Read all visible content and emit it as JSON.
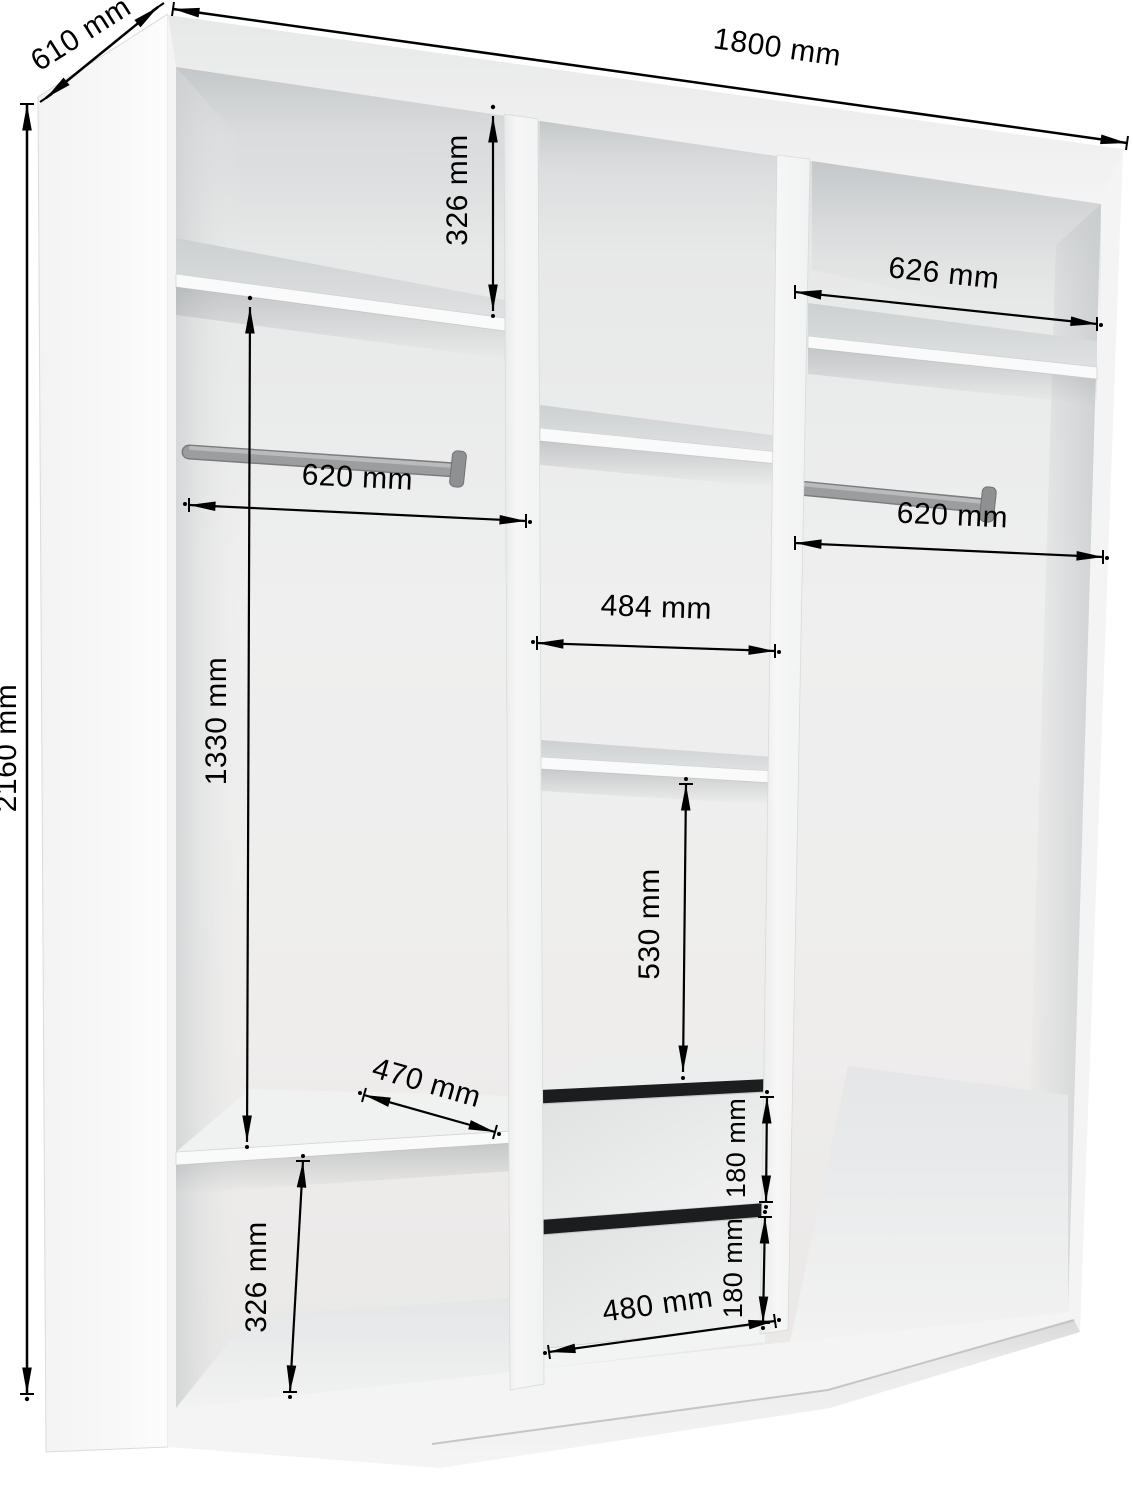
{
  "diagram": {
    "unit": "mm",
    "colors": {
      "dimension_lines": "#000000",
      "hanging_rail": "#9a9c9d",
      "drawer_gap": "#1b1d1f",
      "carcass": "#f4f4f4"
    },
    "dims": {
      "width": "1800 mm",
      "depth": "610 mm",
      "height": "2160 mm",
      "top_section_height": "326 mm",
      "right_shelf_width": "626 mm",
      "left_rail_width": "620 mm",
      "right_rail_width": "620 mm",
      "middle_shelf_width": "484 mm",
      "left_hanging_height": "1330 mm",
      "middle_section_height": "530 mm",
      "left_shelf_depth": "470 mm",
      "left_bottom_height": "326 mm",
      "drawer_top_height": "180 mm",
      "drawer_bottom_height": "180 mm",
      "drawer_width": "480 mm"
    }
  }
}
